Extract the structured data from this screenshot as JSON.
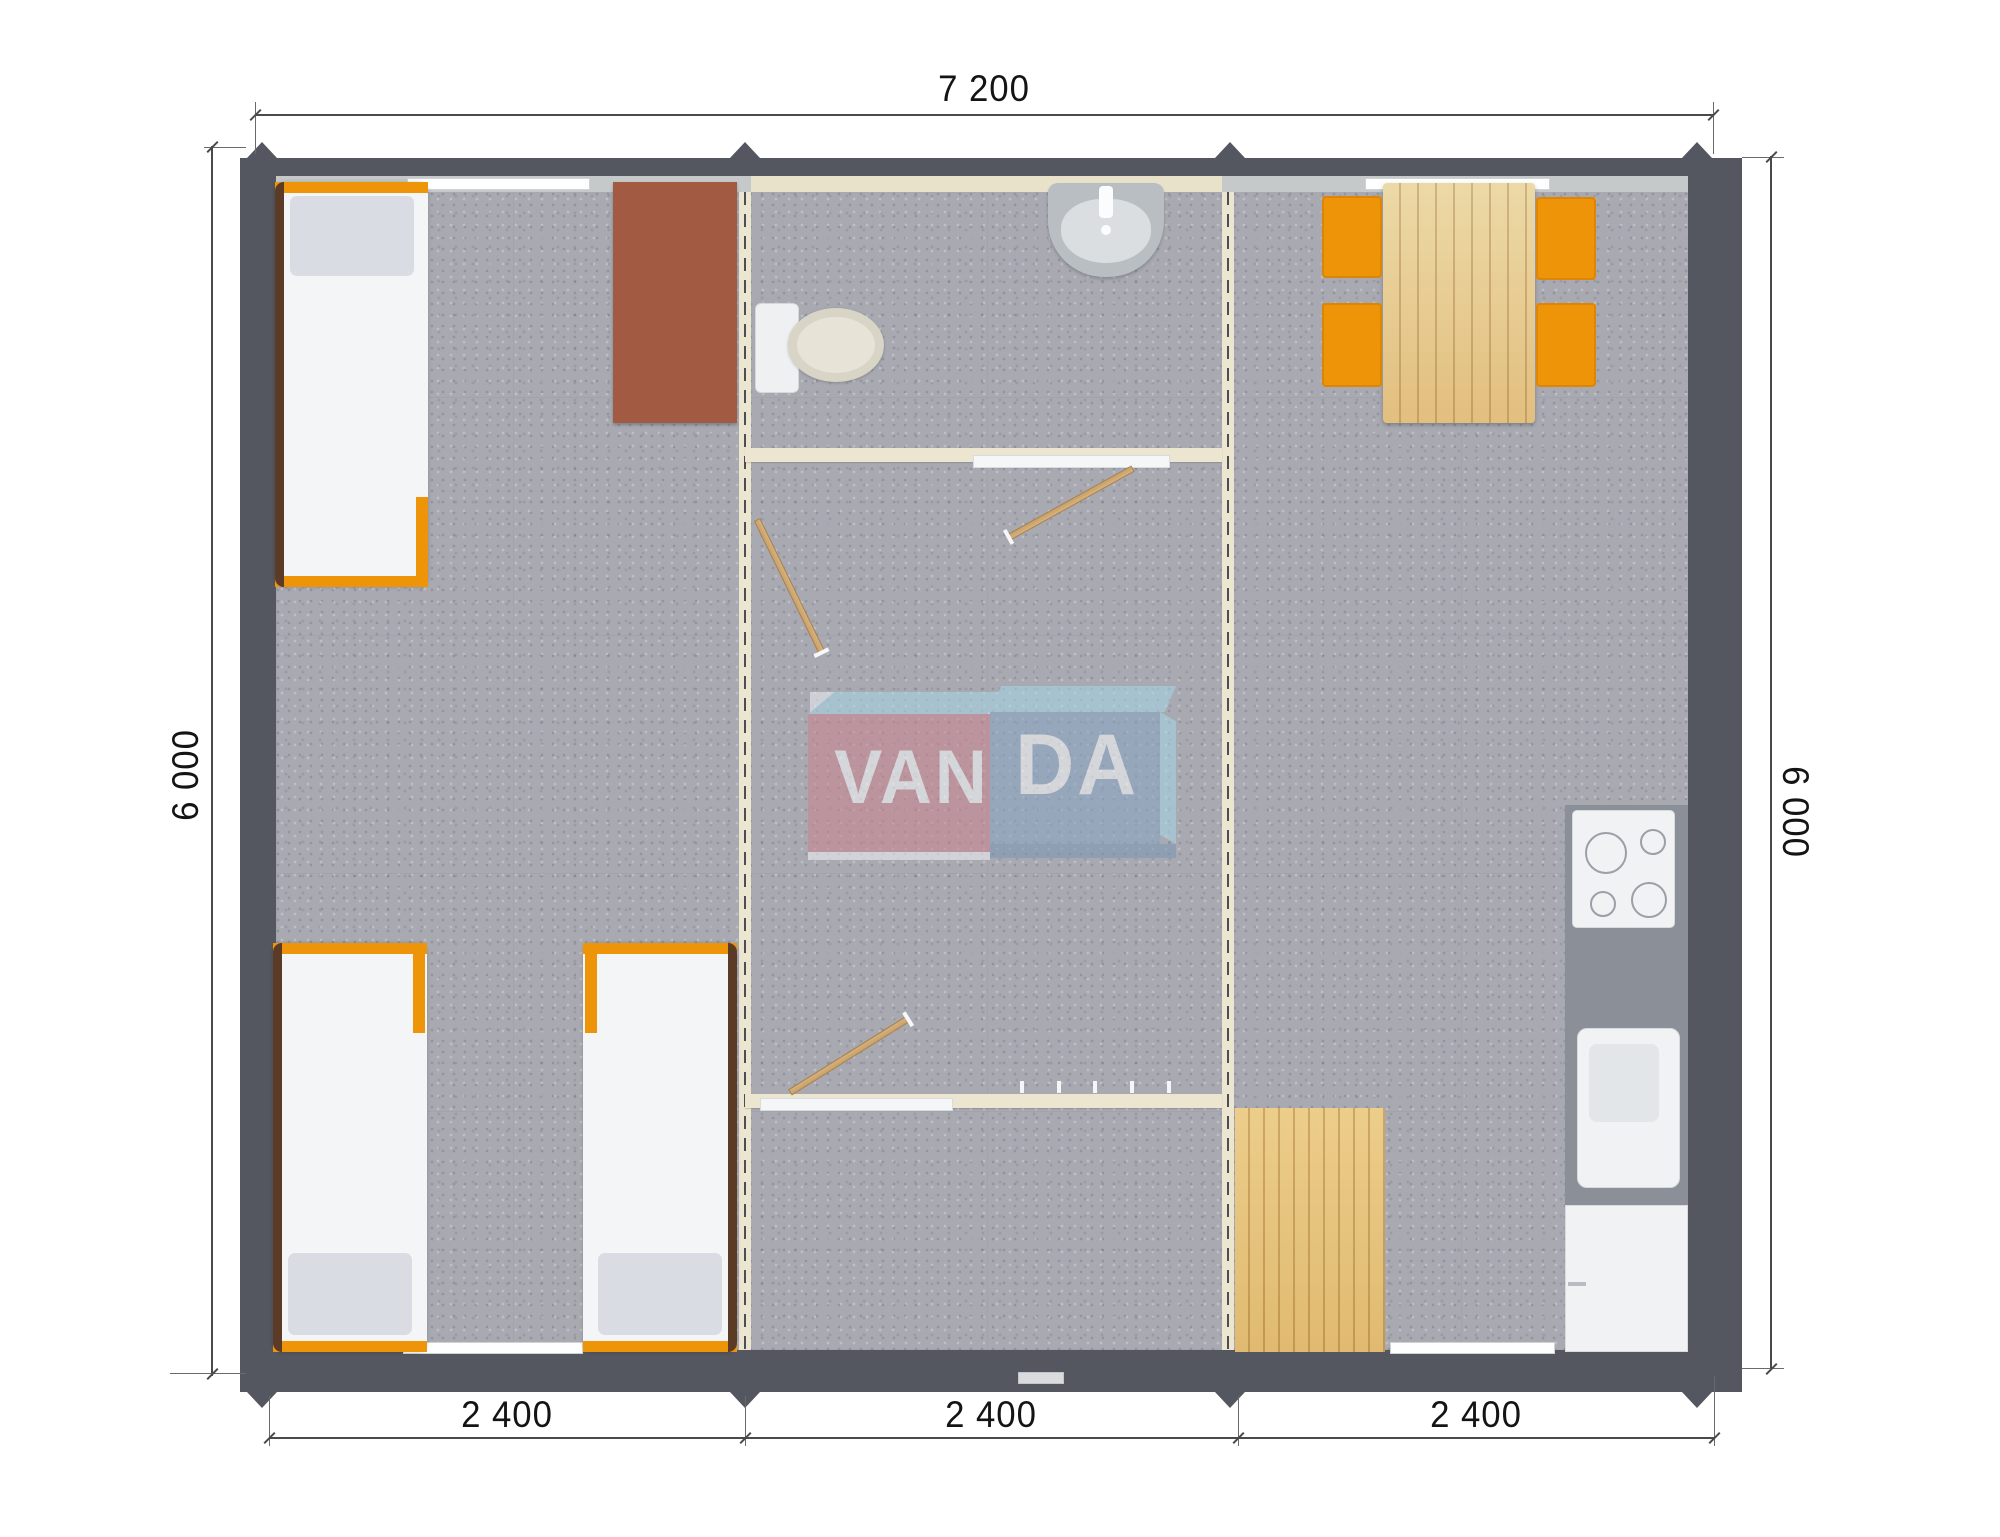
{
  "watermark": {
    "van": "VAN",
    "da": "DA"
  },
  "dimensions": {
    "top": "7 200",
    "left": "6 000",
    "right": "6 000",
    "bottom": [
      "2 400",
      "2 400",
      "2 400"
    ]
  },
  "plan": {
    "overall_width_mm": 7200,
    "overall_depth_mm": 6000,
    "module_width_mm": 2400,
    "module_count": 3
  },
  "colors": {
    "wall": "#54575f",
    "wallLiner": "#c6c9c9",
    "floor": "#a9a9b2",
    "partition": "#ece5cf",
    "orange": "#ee9408",
    "wood": "#e2bf7f",
    "desk": "#a25a42",
    "doorWood": "#c9a169",
    "counter": "#8b8f98",
    "logoRed": "#c9858f",
    "logoBlue": "#8aa6c2",
    "logoLightBlue": "#a7d4e4"
  }
}
